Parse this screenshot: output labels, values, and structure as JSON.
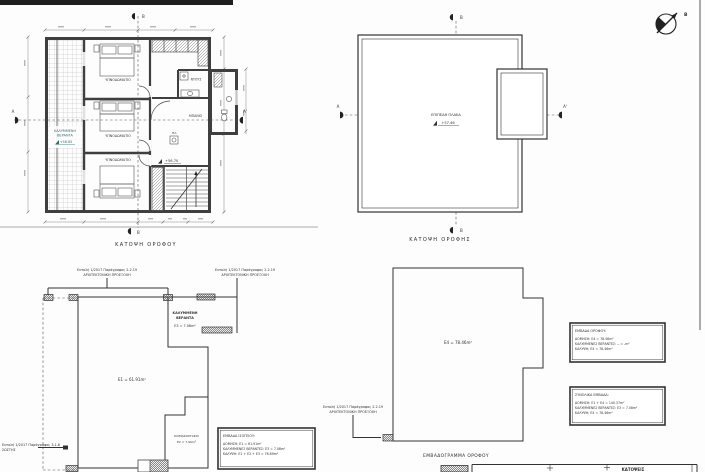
{
  "north": {
    "label": "Β"
  },
  "floor_plan": {
    "caption": "ΚΑΤΟΨΗ ΟΡΟΦΟΥ",
    "rooms": {
      "bedroom": "ΥΠΝΟΔΩΜΑΤΙΟ",
      "shower": "ΝΤΟΥΣ",
      "bath": "ΜΠΑΝΙΟ",
      "laundry": "ΠΛ."
    },
    "veranda": {
      "line1": "ΚΑΛΥΜΜΕΝΗ",
      "line2": "ΒΕΡΑΝΤΑ",
      "level": "+56.85"
    },
    "level": "+56.70",
    "sections": {
      "a": "Α",
      "a_prime": "Α'",
      "b": "Β"
    }
  },
  "roof_plan": {
    "caption": "ΚΑΤΟΨΗ ΟΡΟΦΗΣ",
    "slab": "ΕΠΙΠΕΔΗ ΠΛΑΚΑ",
    "level": "+57.46",
    "sections": {
      "a": "Α",
      "a_prime": "Α'",
      "b": "Β"
    }
  },
  "ground_diagram": {
    "annotation_code": "Εντολή 1/2017 Παράγραφος 2.2.19",
    "annotation_label": "ΑΡΧΙΤΕΚΤΟΝΙΚΗ ΠΡΟΕΞΟΧΗ",
    "left_note_line1": "Εντολή 1/2017 Παράγραφος 3.1.8",
    "left_note_line2": "ΣΩΣΤΗΣ",
    "veranda": {
      "line1": "ΚΑΛΥΜΜΕΝΗ",
      "line2": "ΒΕΡΑΝΤΑ",
      "area": "Ε3 = 7.08m²"
    },
    "main_area": "Ε1 = 61.91m²",
    "stair": {
      "label": "ΚΛΙΜΑΚΟΣΤΑΣΙΟ",
      "area": "Ε2 = 7.90m²"
    },
    "areas_box": {
      "title": "ΕΜΒΑΔΑ ΙΣΟΓΕΙΟΥ:",
      "line1": "ΔΟΜΗΣΗ: Ε1 = 61.91m²",
      "line2": "ΚΑΛΥΜΜΕΝΕΣ ΒΕΡΑΝΤΕΣ: Ε3 = 7.08m²",
      "line3": "ΚΑΛΥΨΗ: Ε1 + Ε2 + Ε3 = 76.89m²"
    }
  },
  "floor_diagram": {
    "caption": "ΕΜΒΑΔΟΓΡΑΜΜΑ ΟΡΟΦΟΥ",
    "annotation_code": "Εντολή 1/2017 Παράγραφος 2.2.19",
    "annotation_label": "ΑΡΧΙΤΕΚΤΟΝΙΚΗ ΠΡΟΕΞΟΧΗ",
    "main_area": "Ε4 = 78.46m²",
    "areas_box": {
      "title": "ΕΜΒΑΔΑ ΟΡΟΦΟΥ:",
      "line1": "ΔΟΜΗΣΗ: Ε4 = 78.46m²",
      "line2": "ΚΑΛΥΜΜΕΝΕΣ ΒΕΡΑΝΤΕΣ: -- = -m²",
      "line3": "ΚΑΛΥΨΗ: Ε4 = 78.46m²"
    },
    "totals_box": {
      "title": "ΣΥΝΟΛΙΚΑ ΕΜΒΑΔΑ:",
      "line1": "ΔΟΜΗΣΗ: Ε1 + Ε4 = 140.37m²",
      "line2": "ΚΑΛΥΜΜΕΝΕΣ ΒΕΡΑΝΤΕΣ: Ε3 = 7.08m²",
      "line3": "ΚΑΛΥΨΗ: Ε4 = 78.46m²"
    }
  },
  "bottom_strip": {
    "title": "ΚΑΤΟΨΕΙΣ"
  },
  "colors": {
    "line": "#3a3a3a",
    "teal": "#2e6e6e"
  }
}
